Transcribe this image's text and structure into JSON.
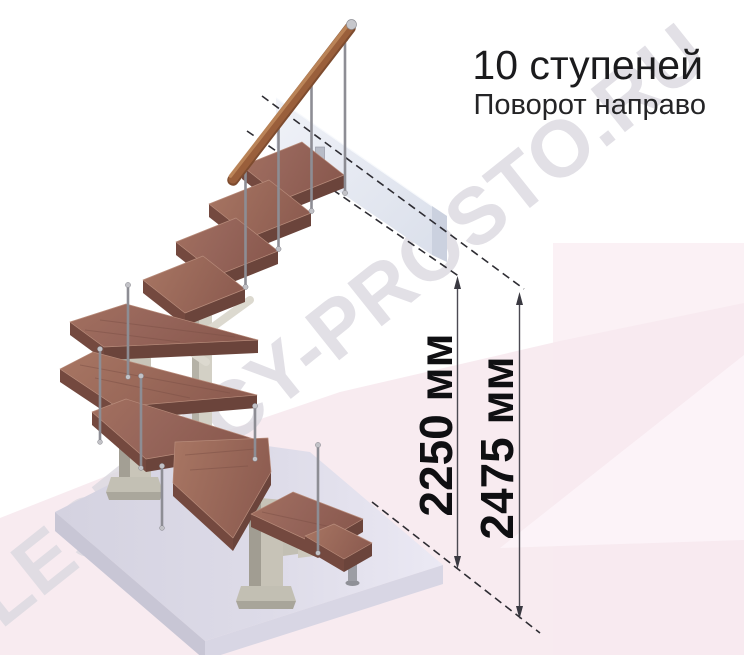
{
  "header": {
    "title": "10 ступеней",
    "subtitle": "Поворот направо"
  },
  "dimensions": [
    {
      "label": "2250 мм",
      "value_mm": 2250
    },
    {
      "label": "2475 мм",
      "value_mm": 2475
    }
  ],
  "watermark": {
    "text": "LESTNICY-PROSTO.RU"
  },
  "diagram": {
    "steps": 10,
    "turn_direction": "направо",
    "description": "модульная лестница с поворотом направо"
  },
  "palette": {
    "ink": "#1b1b1d",
    "subtitle_ink": "#242426",
    "dim_ink": "#0f0f12",
    "watermark": "#dbd9e0",
    "pink_main": "#f7e9ef",
    "pink_light": "#fbf1f5",
    "wood_tread": "#9a685b",
    "wood_rail": "#9a5f3b",
    "steel_column": "#c7c3b7",
    "slab": "#dcdae6",
    "landing": "#e9ecf3"
  }
}
